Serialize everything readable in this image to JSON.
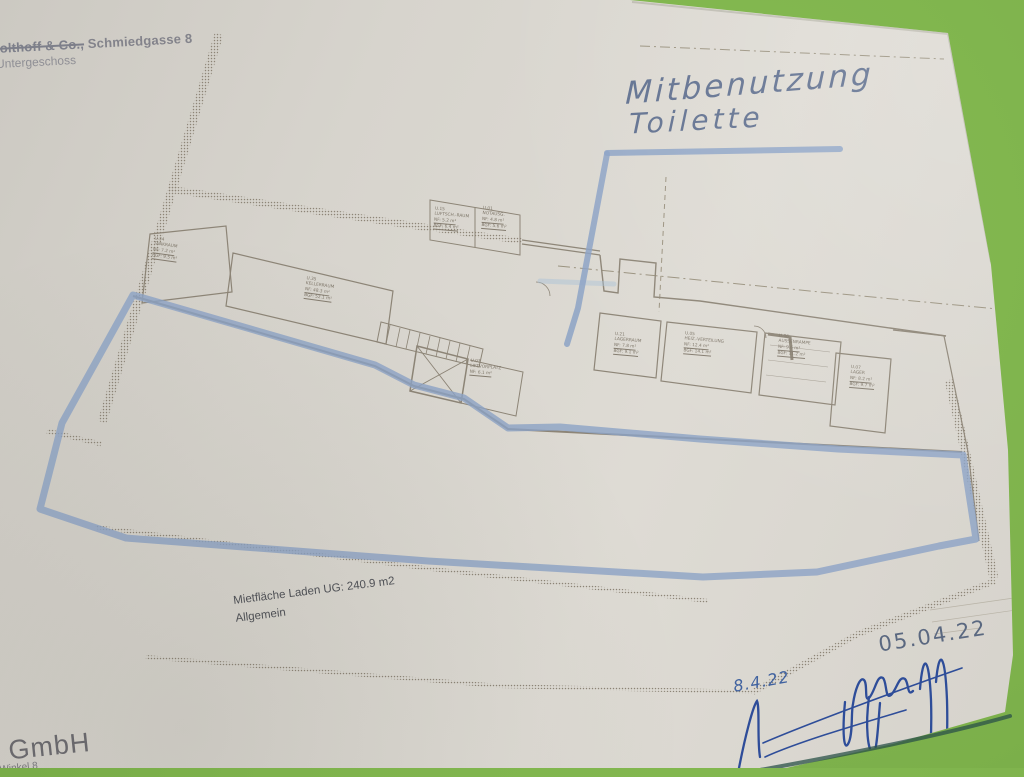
{
  "header": {
    "company_struck": "Kolthoff & Co.,",
    "address": "Schmiedgasse 8",
    "floor_label": "Untergeschoss"
  },
  "handwriting": {
    "line1": "Mitbenutzung",
    "line2": "Toilette",
    "date_top": "05.04.22",
    "date_small": "8.4.22"
  },
  "area_note": {
    "line1": "Mietfläche Laden UG: 240.9 m2",
    "line2": "Allgemein"
  },
  "footer": {
    "company": "f GmbH",
    "address": "Winkel 8"
  },
  "rooms": [
    {
      "id": "U.34",
      "name": "TANKRAUM",
      "nf": "NF: 7.2 m²",
      "bgf": "BGF: 9.5 m²"
    },
    {
      "id": "U.35",
      "name": "KELLERRAUM",
      "nf": "NF: 48.3 m²",
      "bgf": "BGF: 52.1 m²"
    },
    {
      "id": "U.15",
      "name": "LUFTSCH.-RAUM",
      "nf": "NF: 5.2 m²",
      "bgf": "BGF: 6.4 m²"
    },
    {
      "id": "U.01",
      "name": "NOTAUSG.",
      "nf": "NF: 4.8 m²",
      "bgf": "BGF: 5.6 m²"
    },
    {
      "id": "U.03",
      "name": "LIFTVORPLATZ",
      "nf": "NF: 6.1 m²",
      "bgf": "BGF: 7.3 m²"
    },
    {
      "id": "U.21",
      "name": "LAGERRAUM",
      "nf": "NF: 7.8 m²",
      "bgf": "BGF: 9.1 m²"
    },
    {
      "id": "U.05",
      "name": "HEIZ.-VERTEILUNG",
      "nf": "NF: 12.4 m²",
      "bgf": "BGF: 14.1 m²"
    },
    {
      "id": "U.06",
      "name": "AUSSENRAMPE",
      "nf": "NF: 9.6 m²",
      "bgf": "BGF: 11.2 m²"
    },
    {
      "id": "U.07",
      "name": "LAGER",
      "nf": "NF: 8.2 m²",
      "bgf": "BGF: 9.7 m²"
    }
  ],
  "colors": {
    "background_green": "#7eb24c",
    "paper": "#d8d5ce",
    "plan_lines": "#8d8577",
    "highlighter_blue": "#8ca2c6",
    "pen_blue": "#2e4d99"
  }
}
